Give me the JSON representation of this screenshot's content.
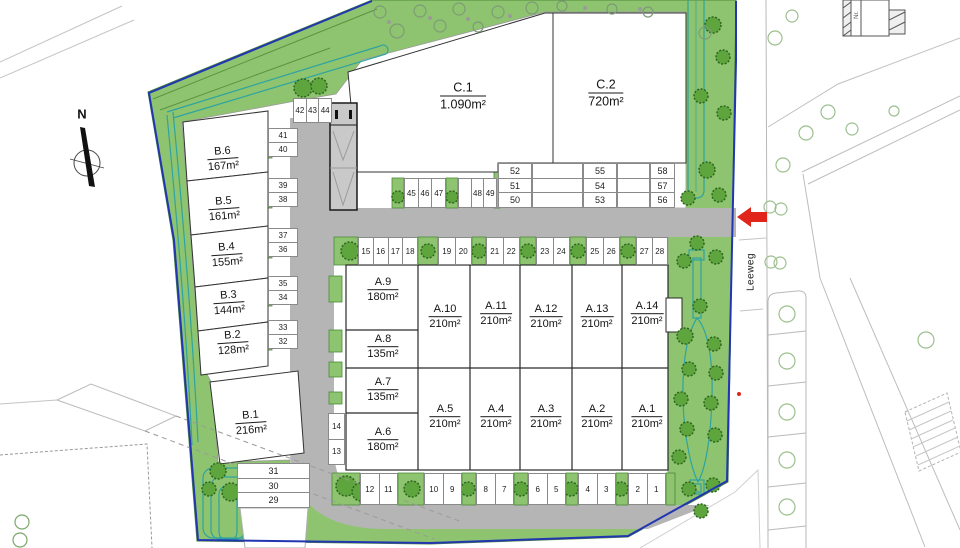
{
  "compass": {
    "north_label": "N"
  },
  "street": {
    "name": "Leeweg"
  },
  "offsite": {
    "building_label": "Nr."
  },
  "plots": {
    "b": [
      {
        "name": "B.6",
        "area": "167m²"
      },
      {
        "name": "B.5",
        "area": "161m²"
      },
      {
        "name": "B.4",
        "area": "155m²"
      },
      {
        "name": "B.3",
        "area": "144m²"
      },
      {
        "name": "B.2",
        "area": "128m²"
      },
      {
        "name": "B.1",
        "area": "216m²"
      }
    ],
    "c": [
      {
        "name": "C.1",
        "area": "1.090m²"
      },
      {
        "name": "C.2",
        "area": "720m²"
      }
    ],
    "a_left": [
      {
        "name": "A.9",
        "area": "180m²"
      },
      {
        "name": "A.8",
        "area": "135m²"
      },
      {
        "name": "A.7",
        "area": "135m²"
      },
      {
        "name": "A.6",
        "area": "180m²"
      }
    ],
    "a_top": [
      {
        "name": "A.10",
        "area": "210m²"
      },
      {
        "name": "A.11",
        "area": "210m²"
      },
      {
        "name": "A.12",
        "area": "210m²"
      },
      {
        "name": "A.13",
        "area": "210m²"
      },
      {
        "name": "A.14",
        "area": "210m²"
      }
    ],
    "a_bottom": [
      {
        "name": "A.5",
        "area": "210m²"
      },
      {
        "name": "A.4",
        "area": "210m²"
      },
      {
        "name": "A.3",
        "area": "210m²"
      },
      {
        "name": "A.2",
        "area": "210m²"
      },
      {
        "name": "A.1",
        "area": "210m²"
      }
    ]
  },
  "stalls": {
    "row_4244": [
      "42",
      "43",
      "44"
    ],
    "b_pairs": [
      [
        "41",
        "40"
      ],
      [
        "39",
        "38"
      ],
      [
        "37",
        "36"
      ],
      [
        "35",
        "34"
      ],
      [
        "33",
        "32"
      ]
    ],
    "col_313029": [
      "31",
      "30",
      "29"
    ],
    "col_1413": [
      "14",
      "13"
    ],
    "row_454647": [
      "45",
      "46",
      "47"
    ],
    "row_4849": [
      "",
      "48",
      "49"
    ],
    "c_cols": [
      [
        "52",
        "51",
        "50"
      ],
      [
        "55",
        "54",
        "53"
      ],
      [
        "58",
        "57",
        "56"
      ]
    ],
    "a_top": [
      [
        "15",
        "16",
        "17",
        "18"
      ],
      [
        "19",
        "20"
      ],
      [
        "21",
        "22"
      ],
      [
        "23",
        "24"
      ],
      [
        "25",
        "26"
      ],
      [
        "27",
        "28"
      ]
    ],
    "a_bottom": [
      [
        "12",
        "11"
      ],
      [
        "10",
        "9"
      ],
      [
        "8",
        "7"
      ],
      [
        "6",
        "5"
      ],
      [
        "4",
        "3"
      ],
      [
        "2",
        "1"
      ]
    ]
  },
  "colors": {
    "site_green": "#8ec46f",
    "road_gray": "#b5b5b5",
    "boundary_blue": "#2236b2",
    "swale_teal": "#2fa3a0",
    "arrow_red": "#e1251b"
  }
}
